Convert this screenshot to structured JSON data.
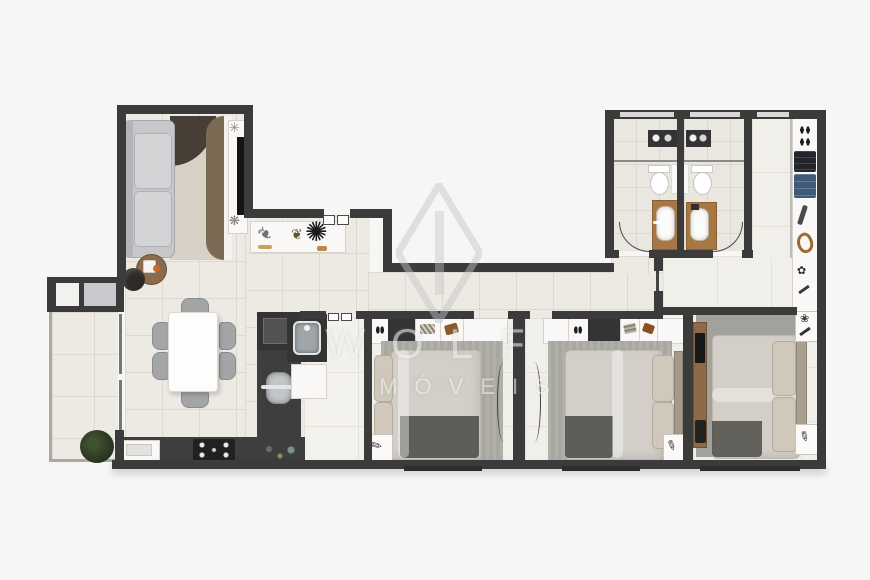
{
  "title": "apartment-floor-plan",
  "watermark": {
    "logo": "diamond-monogram-watermark",
    "line1": "WOLF",
    "line2": "MÓVEIS"
  },
  "rooms": {
    "living": {
      "furniture": [
        "sofa",
        "area-rug",
        "tv-console",
        "side-table",
        "ottoman"
      ]
    },
    "dining": {
      "furniture": [
        "dining-table",
        "chair-x6",
        "sideboard",
        "feather-decor",
        "plant-decor",
        "flower-arrangement"
      ]
    },
    "kitchen": {
      "furniture": [
        "fridge",
        "round-sink",
        "cooktop",
        "knobs",
        "built-in-appliance"
      ]
    },
    "service": {
      "furniture": [
        "laundry-sink",
        "washer"
      ]
    },
    "balcony": {
      "furniture": [
        "window-box",
        "potted-plant",
        "glass-railing"
      ]
    },
    "bathroom_1": {
      "furniture": [
        "toilet",
        "wood-vanity",
        "shower-shelf",
        "glass-partition"
      ]
    },
    "bathroom_2": {
      "furniture": [
        "toilet",
        "wood-vanity",
        "shower-shelf",
        "glass-partition"
      ]
    },
    "bedroom_1": {
      "furniture": [
        "wardrobe",
        "double-bed",
        "rug",
        "nightstand",
        "door"
      ]
    },
    "bedroom_2": {
      "furniture": [
        "wardrobe",
        "double-bed",
        "rug",
        "nightstand",
        "door"
      ]
    },
    "master_suite": {
      "furniture": [
        "closet-shelves",
        "shoes",
        "folded-clothes-black",
        "folded-clothes-blue",
        "tv-panel",
        "double-bed",
        "rug",
        "nightstand-x2"
      ]
    }
  },
  "palette": {
    "bg": "#f6f6f5",
    "wall": "#3c3b3b",
    "floor": "#edeae4",
    "bedroom_floor": "#f1efe9",
    "bath_floor": "#eae7e1",
    "counter": "#3f3e3e",
    "wood": "#a87844",
    "rug_beige": "#d8d1c5",
    "rug_brown": "#7b6a54",
    "rug_dark": "#473f36",
    "bedroom_rug": "#a9a8a0",
    "sofa": "#c6c7c9",
    "bed": "#d3cfc8",
    "throw_dark": "#4e4d49",
    "clothes_blue": "#3e5a78",
    "plant_green": "#2e3a22"
  }
}
